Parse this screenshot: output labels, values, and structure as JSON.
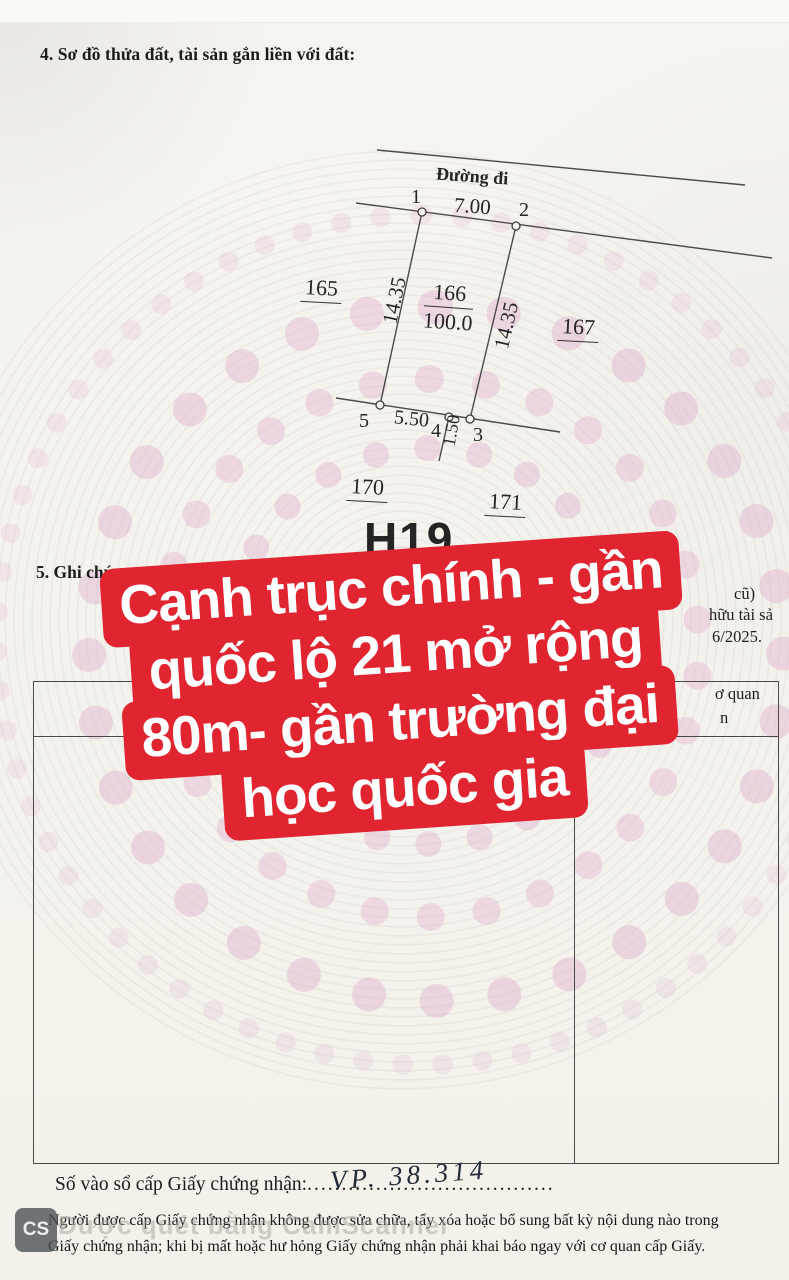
{
  "doc": {
    "section4_heading": "4. Sơ đồ thửa đất, tài sản gắn liền với đất:",
    "section5_heading": "5. Ghi chú:",
    "registry_label": "Số vào sổ cấp Giấy chứng nhận:",
    "registry_handwritten": "VP. 38.314",
    "registry_dots": "....................................",
    "footer_line1": "Người được cấp Giấy chứng nhận không được sửa chữa, tẩy xóa hoặc bổ sung bất kỳ nội dung nào trong",
    "footer_line2": "Giấy chứng nhận; khi bị mất hoặc hư hỏng Giấy chứng nhận phải khai báo ngay với cơ quan cấp Giấy.",
    "fragments": {
      "right_line1": "cũ)",
      "right_line2": "hữu tài sả",
      "right_line3": "6/2025.",
      "table_header_right_line1": "ơ quan",
      "table_header_right_line2": "n"
    }
  },
  "diagram": {
    "road_label": "Đường đi",
    "sheet_code": "H19",
    "point_labels": {
      "p1": "1",
      "p2": "2",
      "p3": "3",
      "p4": "4",
      "p5": "5"
    },
    "lengths": {
      "top": "7.00",
      "left": "14.35",
      "right": "14.35",
      "bottom": "5.50",
      "offset": "1.50"
    },
    "parcel": {
      "number": "166",
      "area": "100.0"
    },
    "adjacent": {
      "left": "165",
      "right": "167",
      "bottom_left": "170",
      "bottom_right": "171"
    }
  },
  "overlay": {
    "color": "#e02430",
    "lines": [
      "Cạnh trục chính - gần",
      "quốc lộ 21 mở rộng",
      "80m- gần trường đại",
      "học quốc gia"
    ]
  },
  "scan_watermark": {
    "logo": "CS",
    "text": "Được quét bằng CamScanner"
  }
}
